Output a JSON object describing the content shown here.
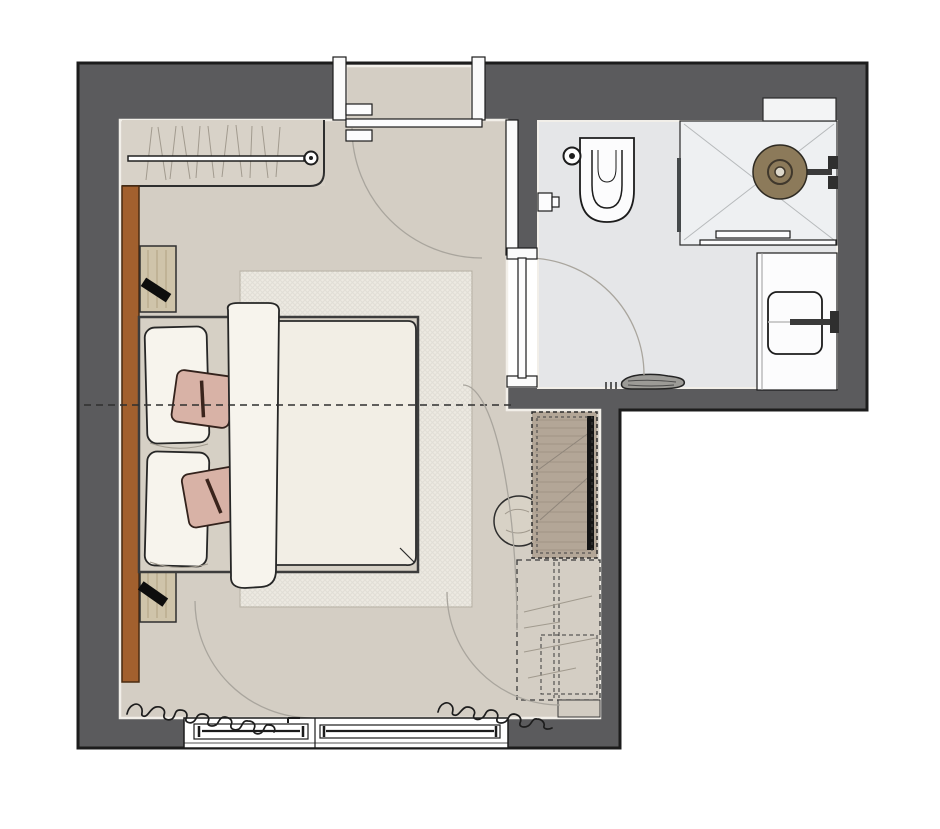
{
  "document": {
    "kind": "floor-plan",
    "description": "Top-down architectural plan of a hotel guest room: bedroom with double bed, wardrobe, nightstands, TV sideboard and window wall, plus en-suite bathroom with walk-in shower, wall-hung toilet and vanity basin."
  },
  "palette": {
    "wall": "#5b5b5d",
    "outline": "#1c1c1c",
    "floor": "#d4cec4",
    "floorSeam": "#f2efe9",
    "bathFloor": "#e5e6e8",
    "tray": "#eef0f2",
    "niche": "#f3f4f5",
    "rug": "#edeae2",
    "rugLine": "#b9b3a6",
    "linen": "#f7f4ed",
    "duvet": "#f2eee5",
    "cushion": "#d8b2a6",
    "woodAccent": "#a2602e",
    "nightstand": "#cfc4aa",
    "grain": "#b0a283",
    "lamp": "#0d0d0d",
    "deskWood": "#b3a697",
    "deskGrain": "#a09485",
    "tv": "#141414",
    "showerHead": "#8c7a5a",
    "fixture": "#fcfcfd",
    "mat": "#9c9b97",
    "arc": "#a9a59d",
    "dashline": "#2f2f2f",
    "sketch": "#a19a8e",
    "glass": "#44484a"
  },
  "rooms": [
    {
      "name": "bedroom"
    },
    {
      "name": "bathroom"
    },
    {
      "name": "entry"
    }
  ],
  "elements": [
    {
      "name": "entry-door",
      "type": "door",
      "swing": "quarter-arc"
    },
    {
      "name": "bathroom-door",
      "type": "door",
      "swing": "quarter-arc"
    },
    {
      "name": "wardrobe-with-rail",
      "type": "closet"
    },
    {
      "name": "wood-accent-wall-panel",
      "type": "panel"
    },
    {
      "name": "nightstand-left",
      "type": "furniture",
      "accessory": "lamp"
    },
    {
      "name": "nightstand-right",
      "type": "furniture",
      "accessory": "lamp"
    },
    {
      "name": "double-bed",
      "type": "furniture",
      "items": [
        "pillow",
        "pillow",
        "decorative-cushion",
        "decorative-cushion",
        "duvet",
        "bed-runner"
      ]
    },
    {
      "name": "area-rug",
      "type": "rug"
    },
    {
      "name": "tv-sideboard",
      "type": "furniture",
      "accessory": "tv-panel"
    },
    {
      "name": "stool",
      "type": "furniture"
    },
    {
      "name": "dashed-luggage-unit",
      "type": "furniture"
    },
    {
      "name": "window-band",
      "type": "window",
      "count": 2
    },
    {
      "name": "curtains",
      "type": "drapery",
      "count": 2
    },
    {
      "name": "walk-in-shower",
      "type": "fixture",
      "items": [
        "rain-shower-head",
        "glass-panel",
        "wall-niche",
        "threshold"
      ]
    },
    {
      "name": "wall-hung-toilet",
      "type": "fixture"
    },
    {
      "name": "floor-drain",
      "type": "fixture"
    },
    {
      "name": "toilet-paper-holder",
      "type": "fixture"
    },
    {
      "name": "vanity-counter-with-basin",
      "type": "fixture",
      "accessory": "wall-faucet"
    },
    {
      "name": "bath-mat",
      "type": "textile"
    }
  ]
}
